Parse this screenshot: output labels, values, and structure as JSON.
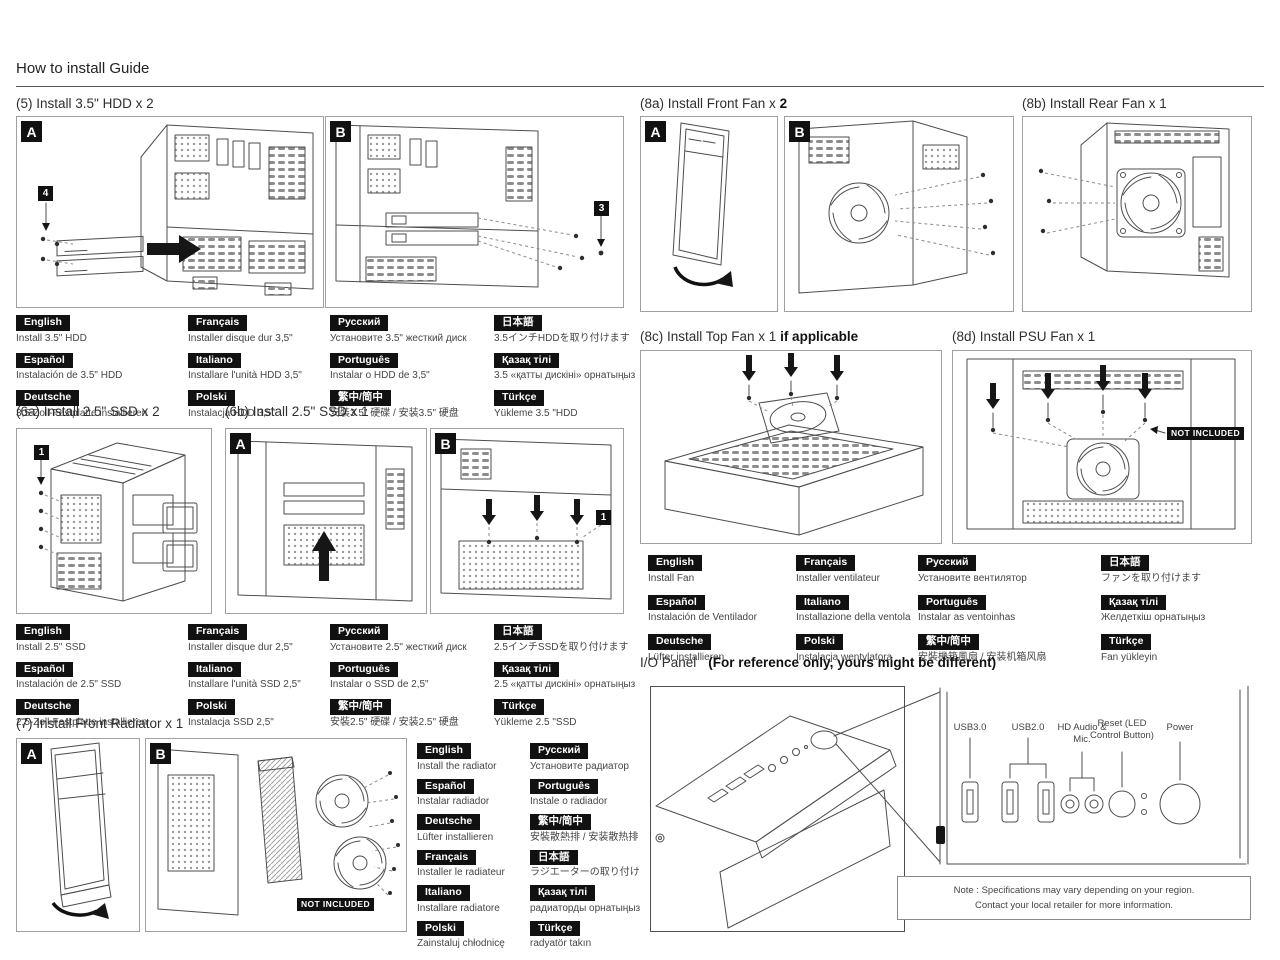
{
  "header": {
    "title": "How to install Guide"
  },
  "colors": {
    "label_bg": "#111111",
    "label_fg": "#ffffff",
    "line": "#4d4d4d"
  },
  "sections": {
    "s5": {
      "title": "(5) Install 3.5\" HDD x 2",
      "badge_a": "A",
      "badge_b": "B",
      "step_num_a": "4",
      "step_num_b": "3",
      "langs": [
        {
          "label": "English",
          "text": "Install 3.5\" HDD"
        },
        {
          "label": "Français",
          "text": "Installer disque dur 3,5\""
        },
        {
          "label": "Русский",
          "text": "Установите 3.5\" жесткий диск"
        },
        {
          "label": "日本語",
          "text": "3.5インチHDDを取り付けます"
        },
        {
          "label": "Español",
          "text": "Instalación de 3.5\" HDD"
        },
        {
          "label": "Italiano",
          "text": "Installare l'unità HDD 3,5\""
        },
        {
          "label": "Português",
          "text": "Instalar o HDD de 3,5\""
        },
        {
          "label": "Қазақ тілі",
          "text": "3.5 «қатты дискіні» орнатыңыз"
        },
        {
          "label": "Deutsche",
          "text": "3,5-Zoll-Festplatte installieren"
        },
        {
          "label": "Polski",
          "text": "Instalacja HDD 3,5\""
        },
        {
          "label": "繁中/简中",
          "text": "安裝3.5\" 硬碟 / 安装3.5\" 硬盘"
        },
        {
          "label": "Türkçe",
          "text": "Yükleme 3.5 \"HDD"
        }
      ]
    },
    "s6a": {
      "title": "(6a) Install 2.5\" SSD x 2",
      "step_num": "1"
    },
    "s6b": {
      "title": "(6b) Install 2.5\" SSD x 1",
      "badge_a": "A",
      "badge_b": "B",
      "step_num": "1"
    },
    "s6_langs": [
      {
        "label": "English",
        "text": "Install 2.5\" SSD"
      },
      {
        "label": "Français",
        "text": "Installer disque dur 2,5\""
      },
      {
        "label": "Русский",
        "text": "Установите 2.5\" жесткий диск"
      },
      {
        "label": "日本語",
        "text": "2.5インチSSDを取り付けます"
      },
      {
        "label": "Español",
        "text": "Instalación de 2.5\" SSD"
      },
      {
        "label": "Italiano",
        "text": "Installare l'unità SSD 2,5\""
      },
      {
        "label": "Português",
        "text": "Instalar o SSD de 2,5\""
      },
      {
        "label": "Қазақ тілі",
        "text": "2.5 «қатты дискіні» орнатыңыз"
      },
      {
        "label": "Deutsche",
        "text": "2,5-Zoll-Festplatte installieren"
      },
      {
        "label": "Polski",
        "text": "Instalacja SSD 2,5\""
      },
      {
        "label": "繁中/简中",
        "text": "安裝2.5\" 硬碟 / 安装2.5\" 硬盘"
      },
      {
        "label": "Türkçe",
        "text": "Yükleme 2.5 \"SSD"
      }
    ],
    "s7": {
      "title": "(7) Install Front Radiator x 1",
      "badge_a": "A",
      "badge_b": "B",
      "not_included": "NOT INCLUDED",
      "langs": [
        {
          "label": "English",
          "text": "Install the radiator"
        },
        {
          "label": "Русский",
          "text": "Установите радиатор"
        },
        {
          "label": "Español",
          "text": "Instalar radiador"
        },
        {
          "label": "Português",
          "text": "Instale o radiador"
        },
        {
          "label": "Deutsche",
          "text": "Lüfter installieren"
        },
        {
          "label": "繁中/简中",
          "text": "安裝散熱排 / 安装散热排"
        },
        {
          "label": "Français",
          "text": "Installer le radiateur"
        },
        {
          "label": "日本語",
          "text": "ラジエーターの取り付け"
        },
        {
          "label": "Italiano",
          "text": "Installare radiatore"
        },
        {
          "label": "Қазақ тілі",
          "text": "радиаторды орнатыңыз"
        },
        {
          "label": "Polski",
          "text": "Zainstaluj chłodnicę"
        },
        {
          "label": "Türkçe",
          "text": "radyatör takın"
        }
      ]
    },
    "s8a": {
      "title": "(8a) Install Front Fan x ",
      "title_bold": "2",
      "badge_a": "A",
      "badge_b": "B"
    },
    "s8b": {
      "title": "(8b) Install Rear Fan x 1"
    },
    "s8c": {
      "title": "(8c) Install Top Fan x 1 ",
      "title_bold": "if applicable"
    },
    "s8d": {
      "title": "(8d) Install PSU Fan x 1",
      "not_included": "NOT INCLUDED"
    },
    "fan_langs": [
      {
        "label": "English",
        "text": "Install Fan"
      },
      {
        "label": "Français",
        "text": "Installer ventilateur"
      },
      {
        "label": "Русский",
        "text": "Установите вентилятор"
      },
      {
        "label": "日本語",
        "text": "ファンを取り付けます"
      },
      {
        "label": "Español",
        "text": "Instalación de Ventilador"
      },
      {
        "label": "Italiano",
        "text": "Installazione della ventola"
      },
      {
        "label": "Português",
        "text": "Instalar as ventoinhas"
      },
      {
        "label": "Қазақ тілі",
        "text": "Желдеткіш орнатыңыз"
      },
      {
        "label": "Deutsche",
        "text": "Lüfter installieren"
      },
      {
        "label": "Polski",
        "text": "Instalacja wentylatora"
      },
      {
        "label": "繁中/简中",
        "text": "安裝機箱風扇 / 安装机箱风扇"
      },
      {
        "label": "Türkçe",
        "text": "Fan yükleyin"
      }
    ],
    "io": {
      "title": "I/O Panel",
      "subtitle": "(For reference only, yours might be different)",
      "port_labels": [
        "USB3.0",
        "USB2.0",
        "HD Audio & Mic.",
        "Reset (LED Control Button)",
        "Power"
      ],
      "note_line1": "Note : Specifications may vary depending on your region.",
      "note_line2": "Contact your local retailer for more information."
    }
  }
}
